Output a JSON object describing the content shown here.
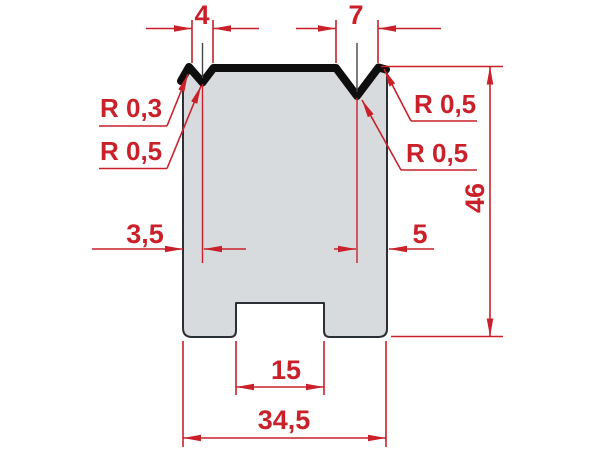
{
  "meta": {
    "type": "technical-drawing",
    "subject": "2V press-brake die cross-section with dimensions"
  },
  "colors": {
    "dimension_red": "#c9202a",
    "body_fill": "#d7dbde",
    "body_outline": "#2b3036",
    "working_edge_black": "#0e0e0e",
    "background": "#ffffff"
  },
  "dimensions": {
    "left_v_width": "4",
    "right_v_width": "7",
    "die_height": "46",
    "left_v_offset": "3,5",
    "right_v_offset": "5",
    "base_slot_width": "15",
    "overall_width": "34,5"
  },
  "radii": {
    "left_shoulder": "R 0,3",
    "left_v_bottom": "R 0,5",
    "right_shoulder": "R 0,5",
    "right_v_bottom": "R 0,5"
  }
}
